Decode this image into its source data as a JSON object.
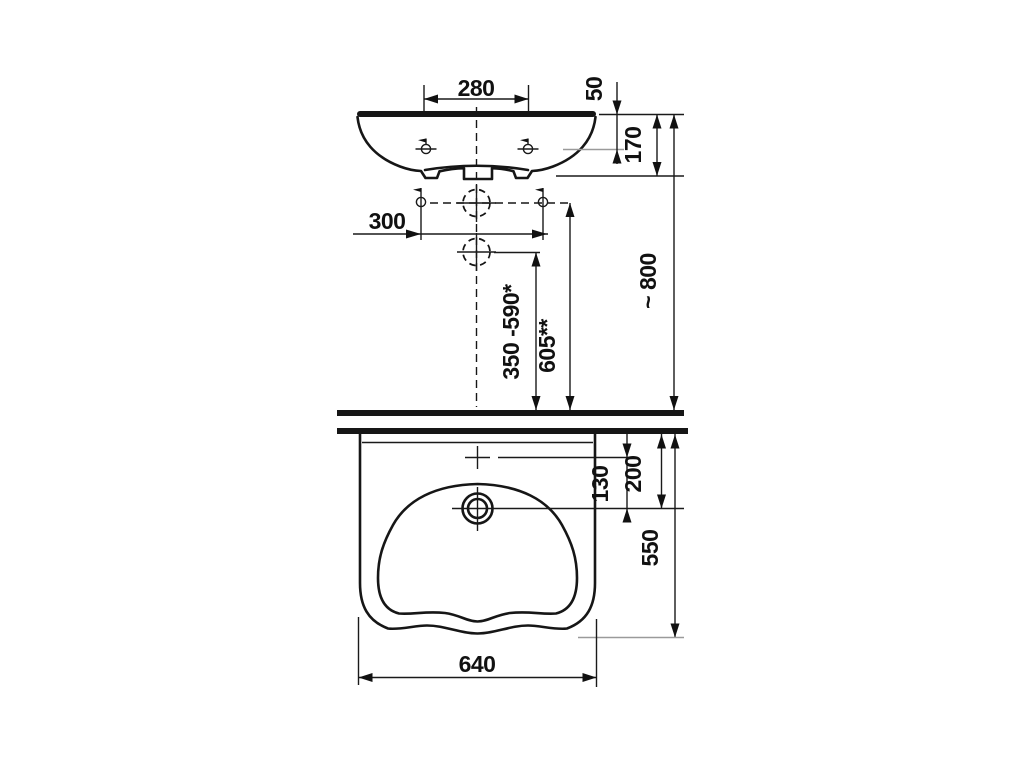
{
  "drawing": {
    "subject": "wall-hung washbasin technical drawing, front elevation (top) and plan view (bottom)",
    "line_color": "#161616",
    "reference_line_color": "#9a9a9a",
    "background": "#ffffff",
    "dimensions": {
      "tap_hole_spacing": "280",
      "rim_to_tap_line": "50",
      "basin_height": "170",
      "fixing_bolt_spacing": "300",
      "drain_trap_height_range": "350 -590*",
      "supply_connection_height": "605**",
      "rim_height_above_floor": "~ 800",
      "tap_hole_to_drain": "130",
      "wall_to_drain_centre": "200",
      "basin_depth": "550",
      "basin_width": "640"
    }
  }
}
